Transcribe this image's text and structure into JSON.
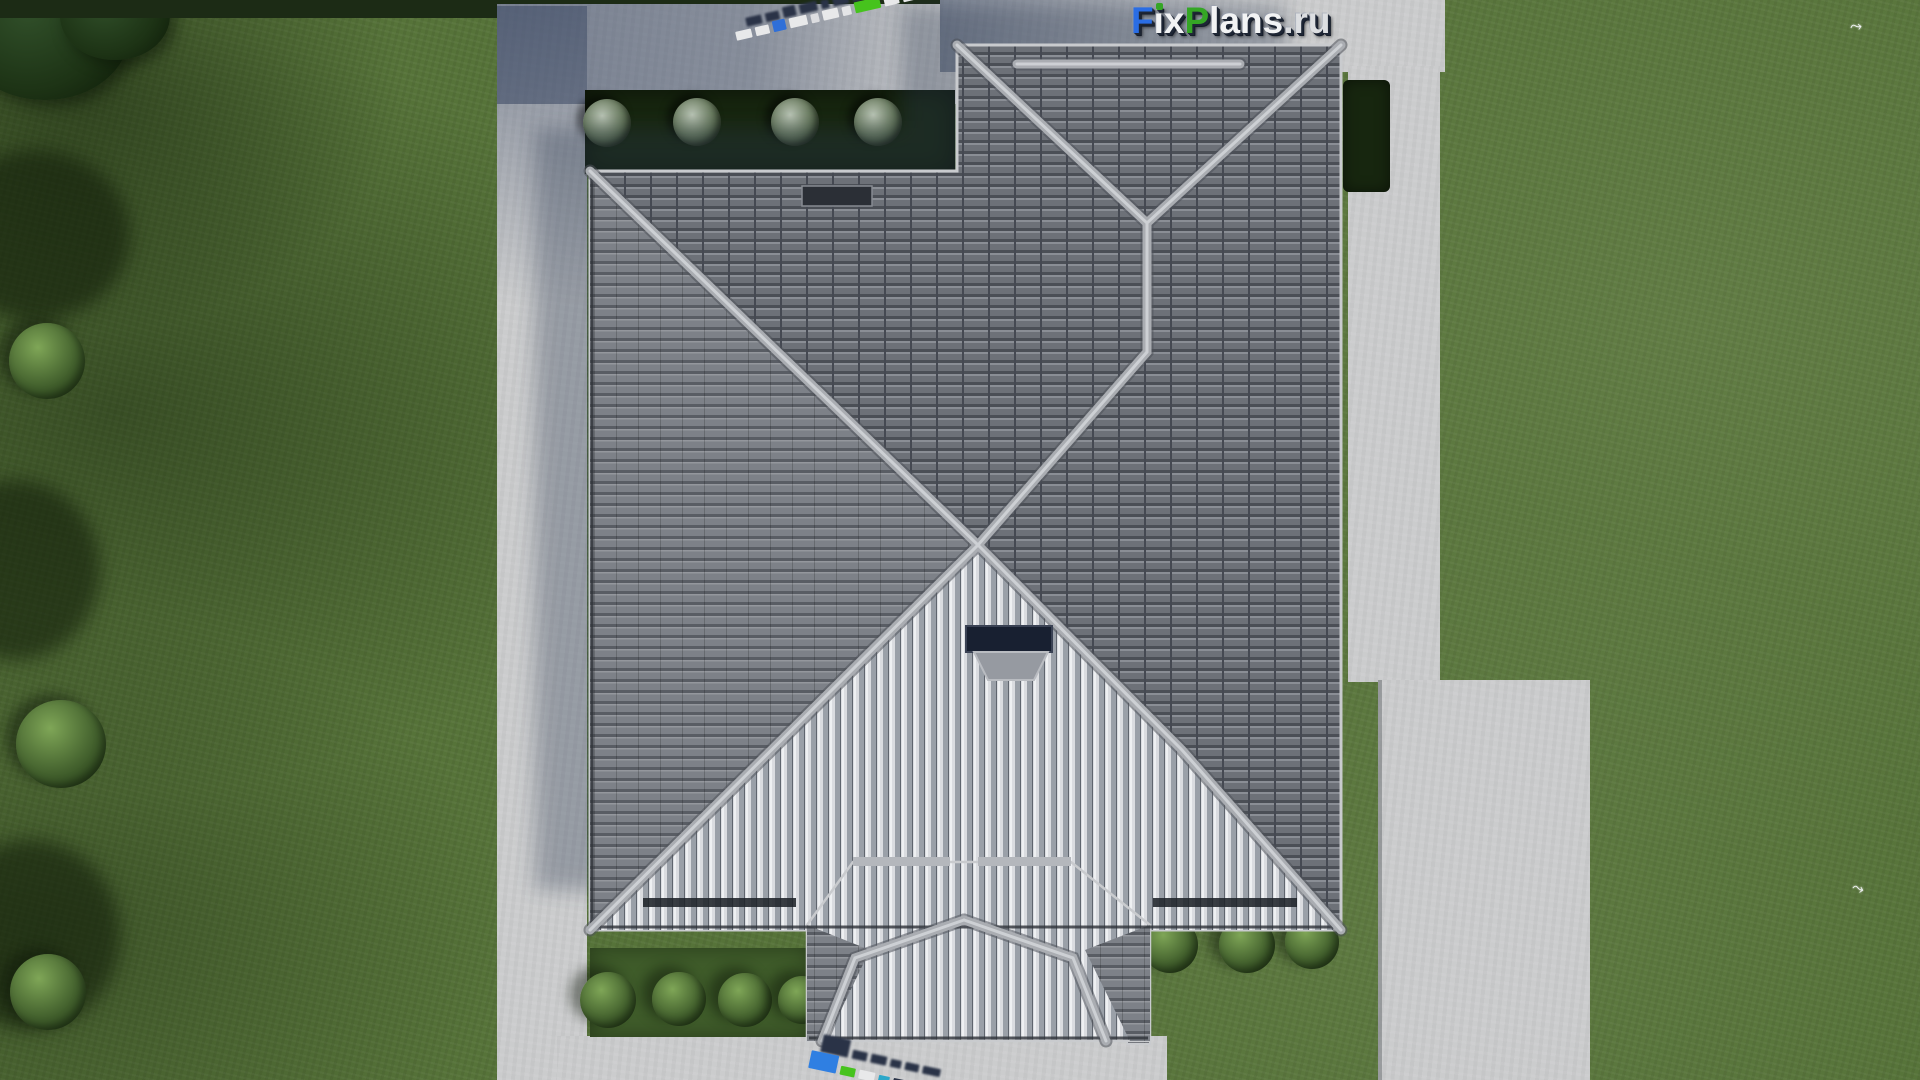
{
  "brand": {
    "logo_text": "FixPlans.ru",
    "logo_letters": [
      {
        "char": "F",
        "color": "#2a6de4"
      },
      {
        "char": "i",
        "color": "#f2f3f4",
        "dot": "#35a625"
      },
      {
        "char": "x",
        "color": "#f2f3f4"
      },
      {
        "char": "P",
        "color": "#35a625"
      },
      {
        "char": "l",
        "color": "#f2f3f4"
      },
      {
        "char": "a",
        "color": "#f2f3f4"
      },
      {
        "char": "n",
        "color": "#f2f3f4"
      },
      {
        "char": "s",
        "color": "#f2f3f4"
      },
      {
        "char": ".",
        "color": "#d8dadd"
      },
      {
        "char": "r",
        "color": "#dcdee1"
      },
      {
        "char": "u",
        "color": "#dcdee1"
      }
    ]
  },
  "palette": {
    "grass": "#567339",
    "bed": "#17260f",
    "hedge": "#1c2b15",
    "bush": "#44622e",
    "bush_light": "#7fa657",
    "pavement": "#cbcccd",
    "pavement_shadow": "#8a8f9c",
    "roof_row_dark": "#4b4f56",
    "roof_row_mid": "#6d7178",
    "roof_row_light": "#7d8188",
    "roof_stripe_light": "#dadce0",
    "roof_stripe_gap": "#9aa0a8",
    "ridge": "#aaadb2",
    "ridge_highlight": "#cdd0d4",
    "glass_dark": "#182031",
    "watermark_blue": "#2f7fe2",
    "watermark_green": "#46c31d",
    "watermark_teal": "#2aa7c9",
    "watermark_white": "#e8e9ea",
    "watermark_shadow": "#2a3347"
  },
  "ground_watermarks": {
    "top_blocks": [
      {
        "w": 16,
        "h": 9,
        "color": "#e8e9ea"
      },
      {
        "w": 14,
        "h": 9,
        "color": "#e8e9ea"
      },
      {
        "w": 13,
        "h": 11,
        "color": "#2f6fd8"
      },
      {
        "w": 18,
        "h": 10,
        "color": "#e8e9ea"
      },
      {
        "w": 8,
        "h": 9,
        "color": "#dcdde0"
      },
      {
        "w": 16,
        "h": 10,
        "color": "#e8e9ea"
      },
      {
        "w": 9,
        "h": 9,
        "color": "#e4e5e7"
      },
      {
        "w": 26,
        "h": 11,
        "color": "#46c31d"
      },
      {
        "w": 15,
        "h": 10,
        "color": "#e8e9ea"
      },
      {
        "w": 14,
        "h": 10,
        "color": "#e8e9ea"
      },
      {
        "w": 10,
        "h": 10,
        "color": "#46c31d"
      },
      {
        "w": 26,
        "h": 19,
        "color": "#2277e0"
      }
    ],
    "bottom_blocks": [
      {
        "w": 28,
        "h": 18,
        "color": "#2f7fe2"
      },
      {
        "w": 15,
        "h": 9,
        "color": "#46c31d"
      },
      {
        "w": 16,
        "h": 9,
        "color": "#e8e9ea"
      },
      {
        "w": 11,
        "h": 8,
        "color": "#2aa7c9"
      },
      {
        "w": 14,
        "h": 8,
        "color": "#2a3347"
      },
      {
        "w": 18,
        "h": 8,
        "color": "#2a3347"
      }
    ]
  }
}
